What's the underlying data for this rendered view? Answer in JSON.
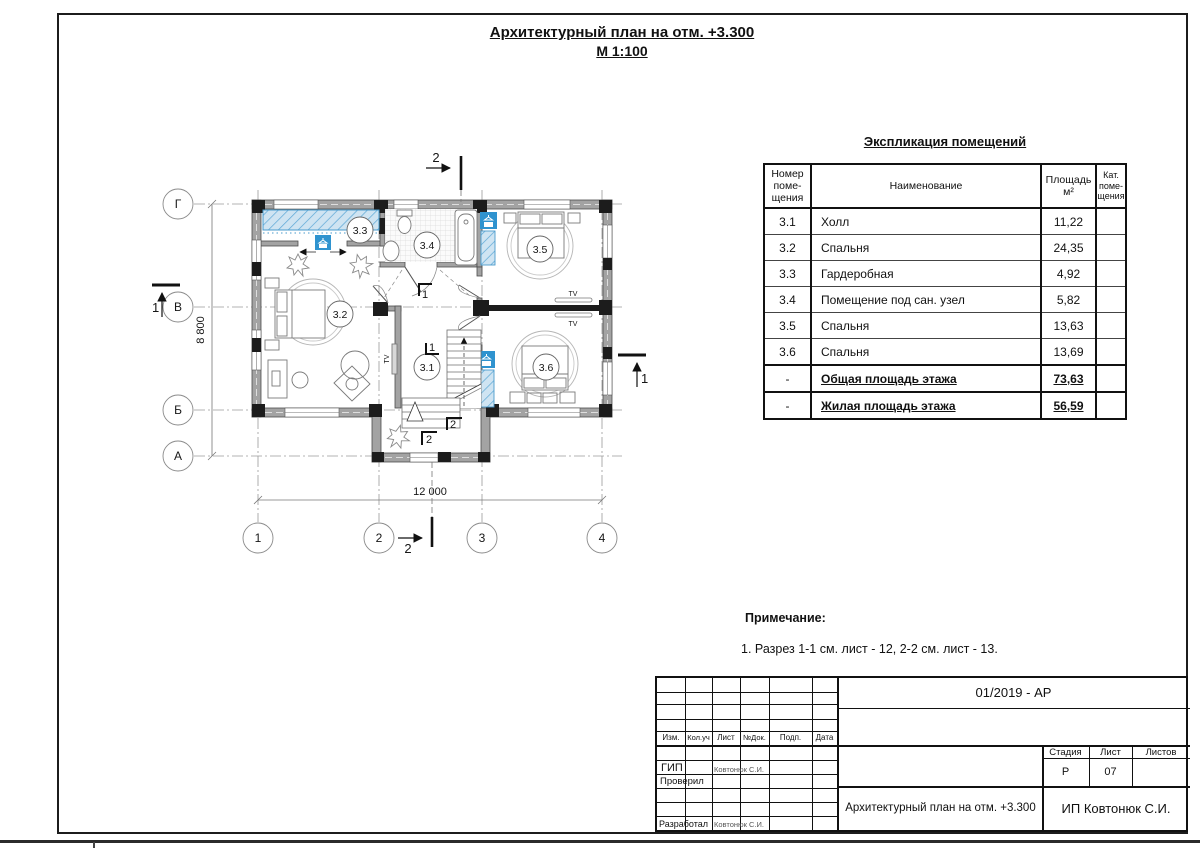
{
  "sheet": {
    "title": "Архитектурный план на отм. +3.300",
    "scale": "М 1:100"
  },
  "plan": {
    "axes_rows": [
      "Г",
      "В",
      "Б",
      "А"
    ],
    "axes_cols": [
      "1",
      "2",
      "3",
      "4"
    ],
    "dim_width": "12 000",
    "dim_height": "8 800",
    "rooms": [
      {
        "number": "3.1"
      },
      {
        "number": "3.2"
      },
      {
        "number": "3.3"
      },
      {
        "number": "3.4"
      },
      {
        "number": "3.5"
      },
      {
        "number": "3.6"
      }
    ],
    "tv_label": "TV",
    "section1": "1",
    "section2": "2"
  },
  "schedule": {
    "title": "Экспликация помещений",
    "headers": {
      "num": "Номер\nпоме-\nщения",
      "name": "Наименование",
      "area": "Площадь\nм²",
      "cat": "Кат.\nпоме-\nщения"
    },
    "rows": [
      {
        "num": "3.1",
        "name": "Холл",
        "area": "11,22",
        "cat": ""
      },
      {
        "num": "3.2",
        "name": "Спальня",
        "area": "24,35",
        "cat": ""
      },
      {
        "num": "3.3",
        "name": "Гардеробная",
        "area": "4,92",
        "cat": ""
      },
      {
        "num": "3.4",
        "name": "Помещение под сан. узел",
        "area": "5,82",
        "cat": ""
      },
      {
        "num": "3.5",
        "name": "Спальня",
        "area": "13,63",
        "cat": ""
      },
      {
        "num": "3.6",
        "name": "Спальня",
        "area": "13,69",
        "cat": ""
      },
      {
        "num": "-",
        "name": "Общая площадь этажа",
        "area": "73,63",
        "cat": ""
      },
      {
        "num": "-",
        "name": "Жилая площадь этажа",
        "area": "56,59",
        "cat": ""
      }
    ]
  },
  "note": {
    "heading": "Примечание:",
    "item1": "1. Разрез 1-1 см. лист - 12, 2-2 см. лист - 13."
  },
  "stamp": {
    "doc_number": "01/2019 - АР",
    "col_izm": "Изм.",
    "col_koluch": "Кол.уч",
    "col_list": "Лист",
    "col_ndok": "№Док.",
    "col_podp": "Подп.",
    "col_data": "Дата",
    "gip_label": "ГИП",
    "gip_name": "Ковтонюк С.И.",
    "checked_label": "Проверил",
    "developed_label": "Разработал",
    "developed_name": "Ковтонюк С.И.",
    "stage_label": "Стадия",
    "sheet_label": "Лист",
    "sheets_label": "Листов",
    "stage_value": "Р",
    "sheet_value": "07",
    "sheets_value": "",
    "drawing_title": "Архитектурный план на отм. +3.300",
    "company": "ИП Ковтонюк С.И."
  },
  "colors": {
    "accent_blue": "#2f93cf",
    "blue_fill": "#bfdcef",
    "wall_gray": "#a3a3a3",
    "line_dark": "#1a1a1a"
  }
}
